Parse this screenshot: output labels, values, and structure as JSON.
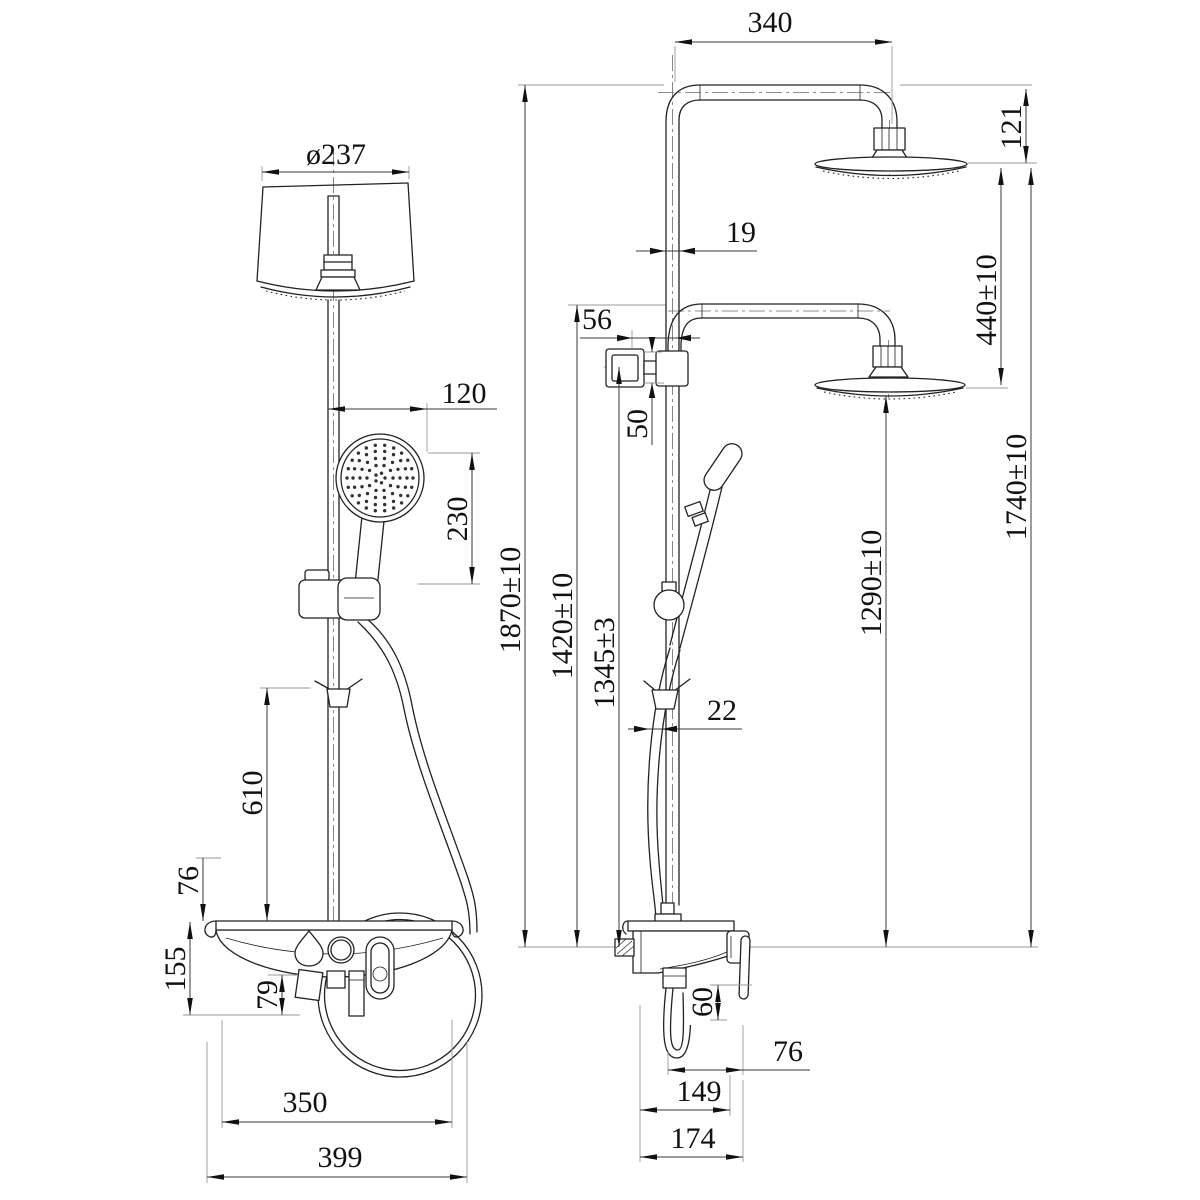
{
  "colors": {
    "background": "#ffffff",
    "object_line": "#222222",
    "dimension_line": "#3a3a3a",
    "extension_line": "#9a9a9a",
    "text": "#111111"
  },
  "dims": {
    "front": {
      "head_diameter": "ø237",
      "hand_shower_offset": "120",
      "hand_shower_length": "230",
      "hook_height": "610",
      "shelf_rim_height": "76",
      "shelf_height": "155",
      "under_shelf_height": "79",
      "shelf_inner_width": "350",
      "shelf_overall_width": "399"
    },
    "side": {
      "arm_reach": "340",
      "head_drop": "121",
      "pipe_diameter": "19",
      "diverter_offset": "56",
      "diverter_height": "50",
      "head_spacing": "440±10",
      "overall_height": "1870±10",
      "lower_arm_height": "1420±10",
      "diverter_center_height": "1345±3",
      "lower_head_height": "1290±10",
      "upper_head_height": "1740±10",
      "slide_bar_diameter": "22",
      "lever_length": "60",
      "hose_to_lever": "76",
      "body_depth": "149",
      "overall_depth": "174"
    }
  }
}
